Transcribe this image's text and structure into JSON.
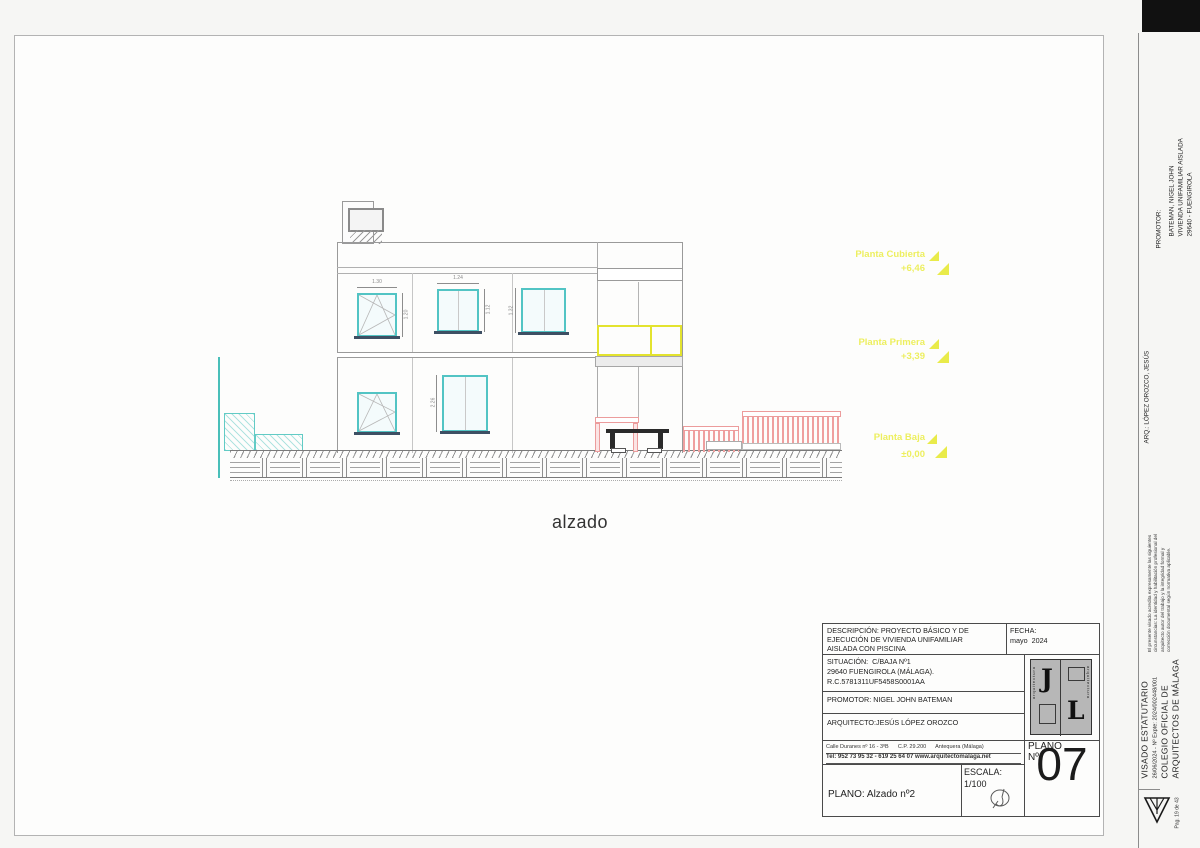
{
  "drawing_label": "alzado",
  "levels": [
    {
      "name": "Planta Cubierta",
      "value": "+6,46"
    },
    {
      "name": "Planta Primera",
      "value": "+3,39"
    },
    {
      "name": "Planta Baja",
      "value": "±0,00"
    }
  ],
  "dimensions": {
    "win_a_w": "1.30",
    "win_a_h": "1.20",
    "win_b_w": "1.24",
    "win_b_h": "1.12",
    "win_c_h": "1.32",
    "door_h": "2.26"
  },
  "title_block": {
    "descripcion_line1": "DESCRIPCIÓN: PROYECTO BÁSICO Y DE",
    "descripcion_line2": "EJECUCIÓN DE VIVIENDA UNIFAMILIAR",
    "descripcion_line3": "AISLADA CON PISCINA",
    "fecha_label": "FECHA:",
    "fecha_value": "mayo  2024",
    "situacion_line1": "SITUACIÓN:  C/BAJA Nº1",
    "situacion_line2": "29640 FUENGIROLA (MÁLAGA).",
    "situacion_line3": "R.C.5781311UF5458S0001AA",
    "promotor": "PROMOTOR: NIGEL JOHN BATEMAN",
    "arquitecto": "ARQUITECTO:JESÚS LÓPEZ OROZCO",
    "address_line1": "Calle Duranes nº 16 - 3ºB      C.P. 29.200      Antequera (Málaga)",
    "address_line2": "Tel: 952 73 95 32 - 619 25 64 07 www.arquitectomalaga.net",
    "plano_title": "PLANO: Alzado nº2",
    "escala_label": "ESCALA:",
    "escala_value": "1/100",
    "plano_num_label1": "PLANO",
    "plano_num_label2": "Nº",
    "plano_num_value": "07",
    "logo_letter1": "J",
    "logo_letter2": "L",
    "logo_side_text": "arquitectura"
  },
  "side_strip": {
    "promotor_label": "PROMOTOR:",
    "promotor_line1": "BATEMAN, NIGEL JOHN",
    "promotor_line2": "VIVIENDA UNIFAMILIAR AISLADA",
    "promotor_line3": "29640 - FUENGIROLA",
    "arq_line": "ARQ.: LÓPEZ OROZCO, JESÚS",
    "note_line1": "El presente visado acredita expresamente las siguientes",
    "note_line2": "circunstancias: La identidad y habilitación profesional del",
    "note_line3": "arquitecto autor del trabajo y la integridad formal y",
    "note_line4": "corrección documental según normativa aplicable.",
    "visado_title": "VISADO ESTATUTARIO",
    "visado_expte": "26/06/2024 - Nº Expte: 2024/002448/001",
    "colegio_line1": "COLEGIO OFICIAL DE",
    "colegio_line2": "ARQUITECTOS DE MÁLAGA",
    "page_note": "Pag. 19 de 43"
  },
  "colors": {
    "accent_cyan": "#52c4c4",
    "accent_pink": "#ef9f9f",
    "accent_yellow": "#e3e32e",
    "annotation_yellow": "#edef5f",
    "sill_dark": "#3d4f63"
  }
}
